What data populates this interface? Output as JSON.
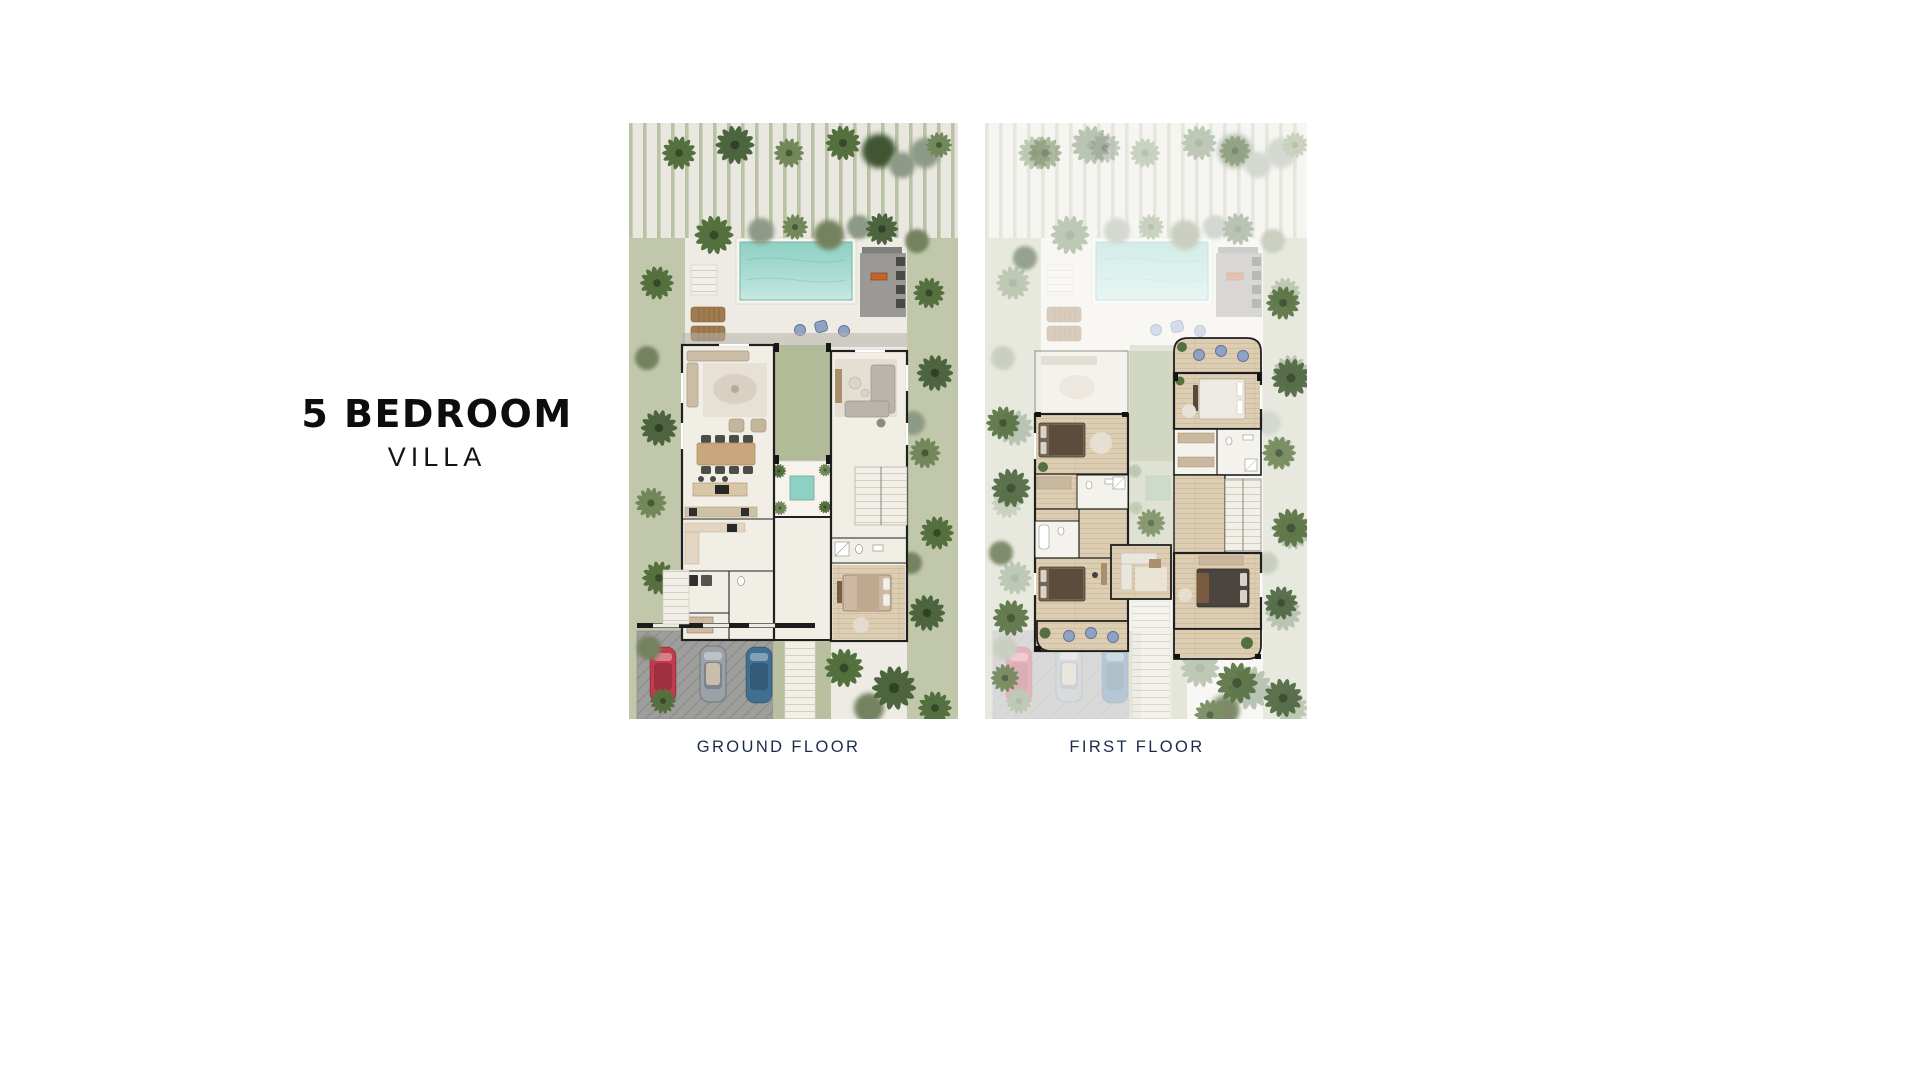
{
  "title": {
    "line1": "5 BEDROOM",
    "line2": "VILLA"
  },
  "plans": [
    {
      "id": "ground-floor",
      "label": "GROUND FLOOR"
    },
    {
      "id": "first-floor",
      "label": "FIRST FLOOR"
    }
  ],
  "palette": {
    "accent_navy": "#1c2b4a",
    "title_black": "#0d0d0d",
    "pool_teal": "#9ad6ca",
    "lawn_green": "#b2bb97",
    "foliage_green": "#55703f",
    "paving_offwhite": "#e9e7df",
    "stripe_green": "#b8c2a5",
    "wood_floor": "#ddcdb3",
    "wall_dark": "#1f1f1f",
    "car_red": "#c13a4e",
    "car_silver": "#9aa1a9",
    "car_blue": "#3f6f92",
    "pouf_blue": "#8fa2c6",
    "fire_table_orange": "#c2642c"
  }
}
